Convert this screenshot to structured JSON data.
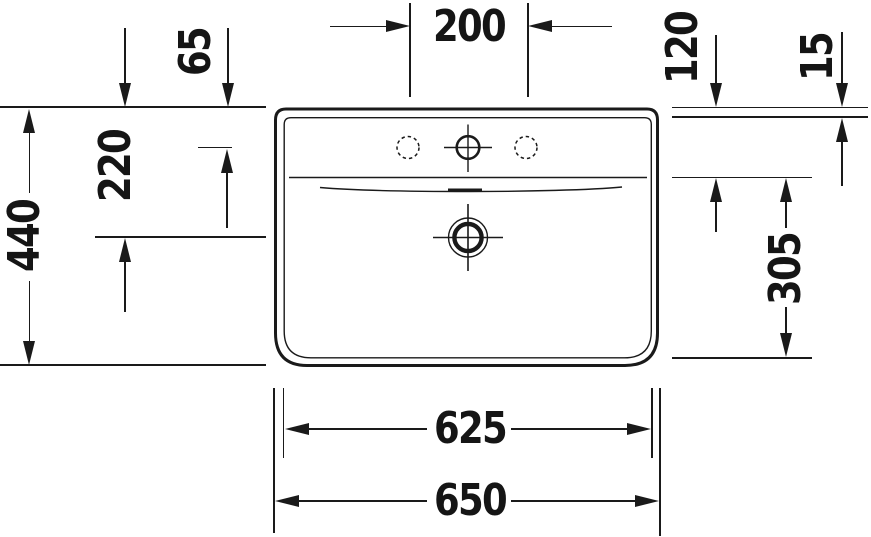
{
  "drawing": {
    "subject": "Washbasin technical drawing, top view",
    "units": "mm",
    "line_color": "#1a1a1a",
    "dim": {
      "hole_spacing": "200",
      "top_to_holes": "65",
      "top_to_rim": "120",
      "rim_edge": "15",
      "overall_depth": "440",
      "top_to_drain": "220",
      "rim_to_front": "305",
      "inner_width": "625",
      "overall_width": "650"
    }
  }
}
